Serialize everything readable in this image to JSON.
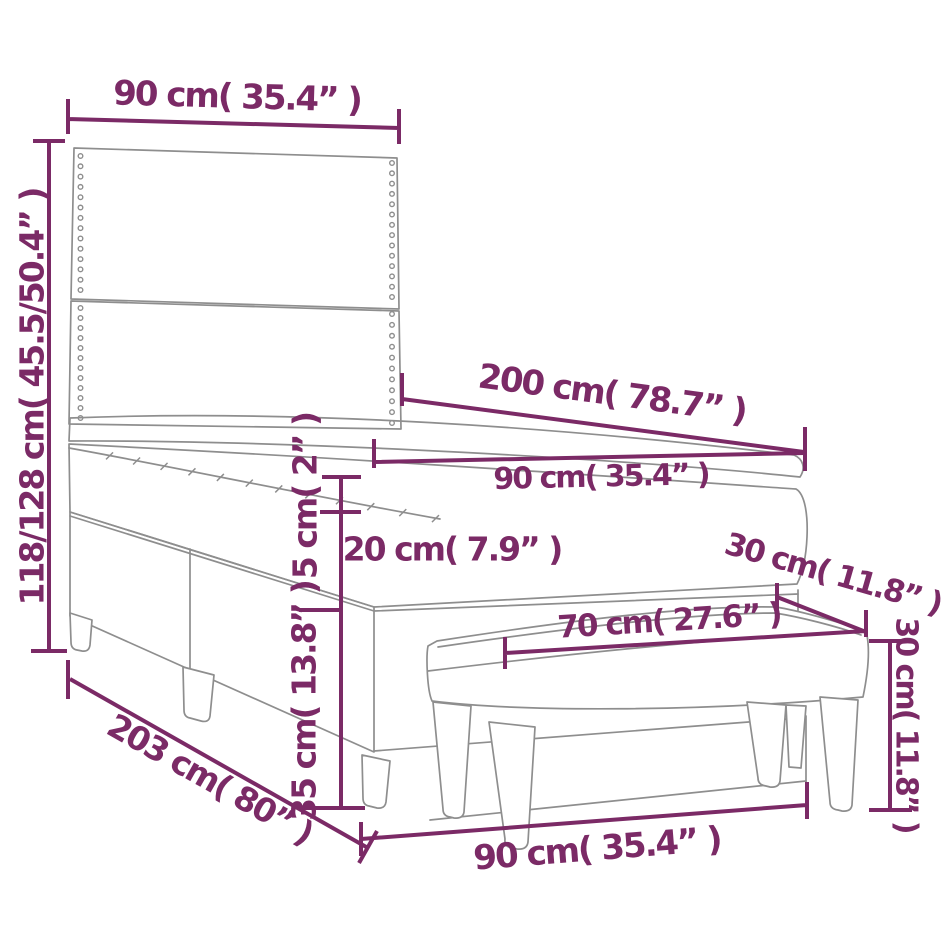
{
  "diagram": {
    "type": "product-dimension-diagram",
    "subject": "box spring bed with headboard, topper, mattress and bench",
    "colors": {
      "dimension_accent": "#7b2a66",
      "outline_gray": "#8e8e8e",
      "background": "#ffffff"
    },
    "labels": {
      "headboard_width": "90 cm( 35.4” )",
      "total_height": "118/128 cm( 45.5/50.4” )",
      "bed_length": "200 cm( 78.7” )",
      "mattress_width": "90 cm( 35.4” )",
      "topper_thickness": "5 cm( 2” )",
      "mattress_thickness": "20 cm( 7.9” )",
      "base_height": "35 cm( 13.8” )",
      "base_length": "203 cm( 80” )",
      "bench_depth": "30 cm( 11.8” )",
      "bench_length": "70 cm( 27.6” )",
      "bench_height": "30 cm( 11.8” )",
      "bed_width_bottom": "90 cm( 35.4” )"
    }
  }
}
